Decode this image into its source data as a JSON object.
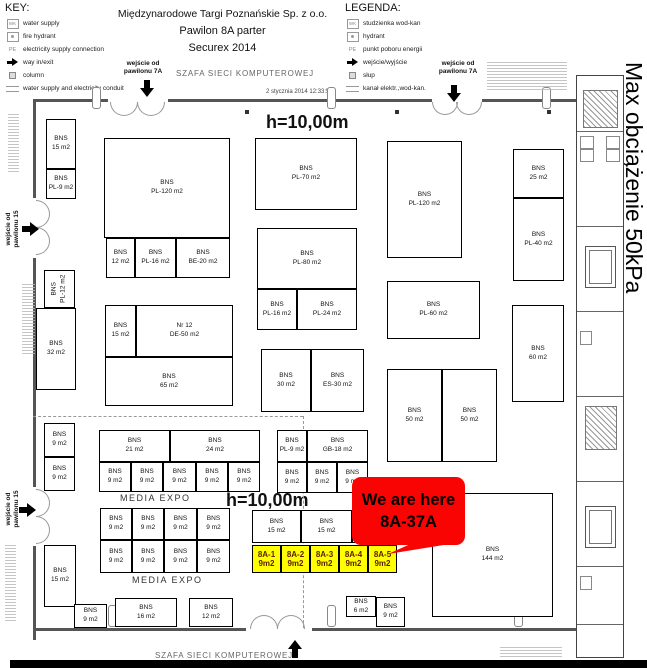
{
  "key": {
    "title": "KEY:",
    "items": [
      {
        "icon": "water-supply-icon",
        "label": "water supply"
      },
      {
        "icon": "fire-hydrant-icon",
        "label": "fire hydrant"
      },
      {
        "icon": "electricity-icon",
        "label": "electricity supply connection"
      },
      {
        "icon": "entrance-arrow-icon",
        "label": "way in/exit"
      },
      {
        "icon": "column-icon",
        "label": "column"
      },
      {
        "icon": "conduit-icon",
        "label": "water supply and electricity conduit"
      }
    ]
  },
  "legend": {
    "title": "LEGENDA:",
    "items": [
      {
        "icon": "water-supply-icon",
        "label": "studzienka wod-kan"
      },
      {
        "icon": "fire-hydrant-icon",
        "label": "hydrant"
      },
      {
        "icon": "electricity-icon",
        "label": "punkt poboru energii"
      },
      {
        "icon": "entrance-arrow-icon",
        "label": "wejście/wyjście"
      },
      {
        "icon": "column-icon",
        "label": "słup"
      },
      {
        "icon": "conduit-icon",
        "label": "kanał elektr.,wod-kan."
      }
    ]
  },
  "title": {
    "line1": "Międzynarodowe Targi Poznańskie Sp. z o.o.",
    "line2": "Pawilon 8A parter",
    "line3": "Securex 2014"
  },
  "entrances": {
    "top1_l1": "wejście od",
    "top1_l2": "pawilonu 7A",
    "top2_l1": "wejście od",
    "top2_l2": "pawilonu 7A",
    "left1_l1": "wejście od",
    "left1_l2": "pawilonu 15",
    "left2_l1": "wejście od",
    "left2_l2": "pawilonu 15"
  },
  "misc": {
    "szafa_top": "SZAFA SIECI KOMPUTEROWEJ",
    "szafa_bottom": "SZAFA SIECI KOMPUTEROWEJ",
    "timestamp": "2 stycznia 2014 12:33:50",
    "max_load": "Max obciążenie 50kPa",
    "h_top": "h=10,00m",
    "h_mid": "h=10,00m",
    "media_expo_top": "MEDIA EXPO",
    "media_expo_bottom": "MEDIA EXPO"
  },
  "callout": {
    "line1": "We are here",
    "line2": "8A-37A",
    "color": "#fa0303",
    "text_color": "#000000"
  },
  "highlight": {
    "fill": "#ffff00",
    "text_color": "#5a1d00",
    "booths": [
      {
        "x": 252,
        "y": 545,
        "w": 29,
        "h": 28,
        "id": "8A-1",
        "size": "9m2"
      },
      {
        "x": 281,
        "y": 545,
        "w": 29,
        "h": 28,
        "id": "8A-2",
        "size": "9m2"
      },
      {
        "x": 310,
        "y": 545,
        "w": 29,
        "h": 28,
        "id": "8A-3",
        "size": "9m2"
      },
      {
        "x": 339,
        "y": 545,
        "w": 29,
        "h": 28,
        "id": "8A-4",
        "size": "9m2"
      },
      {
        "x": 368,
        "y": 545,
        "w": 29,
        "h": 28,
        "id": "8A-5",
        "size": "9m2"
      }
    ]
  },
  "plan": {
    "booths": [
      {
        "x": 46,
        "y": 119,
        "w": 30,
        "h": 50,
        "lines": [
          "BNS",
          "15 m2"
        ]
      },
      {
        "x": 46,
        "y": 169,
        "w": 30,
        "h": 30,
        "lines": [
          "BNS",
          "PL-9 m2"
        ]
      },
      {
        "x": 104,
        "y": 138,
        "w": 126,
        "h": 100,
        "lines": [
          "BNS",
          "PL-120 m2"
        ]
      },
      {
        "x": 106,
        "y": 238,
        "w": 29,
        "h": 40,
        "lines": [
          "BNS",
          "12 m2"
        ]
      },
      {
        "x": 135,
        "y": 238,
        "w": 41,
        "h": 40,
        "lines": [
          "BNS",
          "PL-16 m2"
        ]
      },
      {
        "x": 176,
        "y": 238,
        "w": 54,
        "h": 40,
        "lines": [
          "BNS",
          "BE-20 m2"
        ]
      },
      {
        "x": 44,
        "y": 270,
        "w": 31,
        "h": 38,
        "lines": [
          "BNS",
          "PL-12 m2"
        ],
        "rot": true
      },
      {
        "x": 36,
        "y": 308,
        "w": 40,
        "h": 82,
        "lines": [
          "BNS",
          "32 m2"
        ]
      },
      {
        "x": 105,
        "y": 305,
        "w": 31,
        "h": 52,
        "lines": [
          "BNS",
          "15 m2"
        ]
      },
      {
        "x": 136,
        "y": 305,
        "w": 97,
        "h": 52,
        "lines": [
          "Nr 12",
          "DE-50 m2"
        ]
      },
      {
        "x": 105,
        "y": 357,
        "w": 128,
        "h": 49,
        "lines": [
          "BNS",
          "65 m2"
        ]
      },
      {
        "x": 255,
        "y": 138,
        "w": 102,
        "h": 72,
        "lines": [
          "BNS",
          "PL-70 m2"
        ]
      },
      {
        "x": 257,
        "y": 228,
        "w": 100,
        "h": 61,
        "lines": [
          "BNS",
          "PL-80 m2"
        ]
      },
      {
        "x": 257,
        "y": 289,
        "w": 40,
        "h": 41,
        "lines": [
          "BNS",
          "PL-16 m2"
        ]
      },
      {
        "x": 297,
        "y": 289,
        "w": 60,
        "h": 41,
        "lines": [
          "BNS",
          "PL-24 m2"
        ]
      },
      {
        "x": 261,
        "y": 349,
        "w": 50,
        "h": 63,
        "lines": [
          "BNS",
          "30 m2"
        ]
      },
      {
        "x": 311,
        "y": 349,
        "w": 53,
        "h": 63,
        "lines": [
          "BNS",
          "ES-30 m2"
        ]
      },
      {
        "x": 387,
        "y": 141,
        "w": 75,
        "h": 117,
        "lines": [
          "BNS",
          "PL-120 m2"
        ]
      },
      {
        "x": 387,
        "y": 281,
        "w": 93,
        "h": 58,
        "lines": [
          "BNS",
          "PL-60 m2"
        ]
      },
      {
        "x": 387,
        "y": 369,
        "w": 55,
        "h": 93,
        "lines": [
          "BNS",
          "50 m2"
        ]
      },
      {
        "x": 442,
        "y": 369,
        "w": 55,
        "h": 93,
        "lines": [
          "BNS",
          "50 m2"
        ]
      },
      {
        "x": 513,
        "y": 149,
        "w": 51,
        "h": 49,
        "lines": [
          "BNS",
          "25 m2"
        ]
      },
      {
        "x": 513,
        "y": 198,
        "w": 51,
        "h": 83,
        "lines": [
          "BNS",
          "PL-40 m2"
        ]
      },
      {
        "x": 512,
        "y": 305,
        "w": 52,
        "h": 97,
        "lines": [
          "BNS",
          "60 m2"
        ]
      },
      {
        "x": 44,
        "y": 423,
        "w": 31,
        "h": 34,
        "lines": [
          "BNS",
          "9 m2"
        ]
      },
      {
        "x": 44,
        "y": 457,
        "w": 31,
        "h": 34,
        "lines": [
          "BNS",
          "9 m2"
        ]
      },
      {
        "x": 99,
        "y": 430,
        "w": 71,
        "h": 32,
        "lines": [
          "BNS",
          "21 m2"
        ]
      },
      {
        "x": 170,
        "y": 430,
        "w": 90,
        "h": 32,
        "lines": [
          "BNS",
          "24 m2"
        ]
      },
      {
        "x": 99,
        "y": 462,
        "w": 32,
        "h": 30,
        "lines": [
          "BNS",
          "9 m2"
        ]
      },
      {
        "x": 131,
        "y": 462,
        "w": 32,
        "h": 30,
        "lines": [
          "BNS",
          "9 m2"
        ]
      },
      {
        "x": 163,
        "y": 462,
        "w": 33,
        "h": 30,
        "lines": [
          "BNS",
          "9 m2"
        ]
      },
      {
        "x": 196,
        "y": 462,
        "w": 32,
        "h": 30,
        "lines": [
          "BNS",
          "9 m2"
        ]
      },
      {
        "x": 228,
        "y": 462,
        "w": 32,
        "h": 30,
        "lines": [
          "BNS",
          "9 m2"
        ]
      },
      {
        "x": 277,
        "y": 430,
        "w": 30,
        "h": 32,
        "lines": [
          "BNS",
          "PL-9 m2"
        ]
      },
      {
        "x": 307,
        "y": 430,
        "w": 61,
        "h": 32,
        "lines": [
          "BNS",
          "GB-18 m2"
        ]
      },
      {
        "x": 277,
        "y": 462,
        "w": 30,
        "h": 31,
        "lines": [
          "BNS",
          "9 m2"
        ]
      },
      {
        "x": 307,
        "y": 462,
        "w": 30,
        "h": 31,
        "lines": [
          "BNS",
          "9 m2"
        ]
      },
      {
        "x": 337,
        "y": 462,
        "w": 31,
        "h": 31,
        "lines": [
          "BNS",
          "9 m2"
        ]
      },
      {
        "x": 100,
        "y": 508,
        "w": 32,
        "h": 32,
        "lines": [
          "BNS",
          "9 m2"
        ]
      },
      {
        "x": 132,
        "y": 508,
        "w": 32,
        "h": 32,
        "lines": [
          "BNS",
          "9 m2"
        ]
      },
      {
        "x": 164,
        "y": 508,
        "w": 33,
        "h": 32,
        "lines": [
          "BNS",
          "9 m2"
        ]
      },
      {
        "x": 197,
        "y": 508,
        "w": 33,
        "h": 32,
        "lines": [
          "BNS",
          "9 m2"
        ]
      },
      {
        "x": 100,
        "y": 540,
        "w": 32,
        "h": 33,
        "lines": [
          "BNS",
          "9 m2"
        ]
      },
      {
        "x": 132,
        "y": 540,
        "w": 32,
        "h": 33,
        "lines": [
          "BNS",
          "9 m2"
        ]
      },
      {
        "x": 164,
        "y": 540,
        "w": 33,
        "h": 33,
        "lines": [
          "BNS",
          "9 m2"
        ]
      },
      {
        "x": 197,
        "y": 540,
        "w": 33,
        "h": 33,
        "lines": [
          "BNS",
          "9 m2"
        ]
      },
      {
        "x": 44,
        "y": 545,
        "w": 32,
        "h": 62,
        "lines": [
          "BNS",
          "15 m2"
        ]
      },
      {
        "x": 74,
        "y": 604,
        "w": 33,
        "h": 24,
        "lines": [
          "BNS",
          "9 m2"
        ]
      },
      {
        "x": 115,
        "y": 598,
        "w": 62,
        "h": 29,
        "lines": [
          "BNS",
          "16 m2"
        ]
      },
      {
        "x": 189,
        "y": 598,
        "w": 44,
        "h": 29,
        "lines": [
          "BNS",
          "12 m2"
        ]
      },
      {
        "x": 252,
        "y": 510,
        "w": 49,
        "h": 33,
        "lines": [
          "BNS",
          "15 m2"
        ]
      },
      {
        "x": 301,
        "y": 510,
        "w": 51,
        "h": 33,
        "lines": [
          "BNS",
          "15 m2"
        ]
      },
      {
        "x": 352,
        "y": 510,
        "w": 45,
        "h": 33,
        "lines": []
      },
      {
        "x": 432,
        "y": 493,
        "w": 121,
        "h": 124,
        "lines": [
          "BNS",
          "144 m2"
        ]
      },
      {
        "x": 346,
        "y": 596,
        "w": 30,
        "h": 21,
        "lines": [
          "BNS",
          "6 m2"
        ]
      },
      {
        "x": 376,
        "y": 597,
        "w": 29,
        "h": 30,
        "lines": [
          "BNS",
          "9 m2"
        ]
      }
    ]
  }
}
